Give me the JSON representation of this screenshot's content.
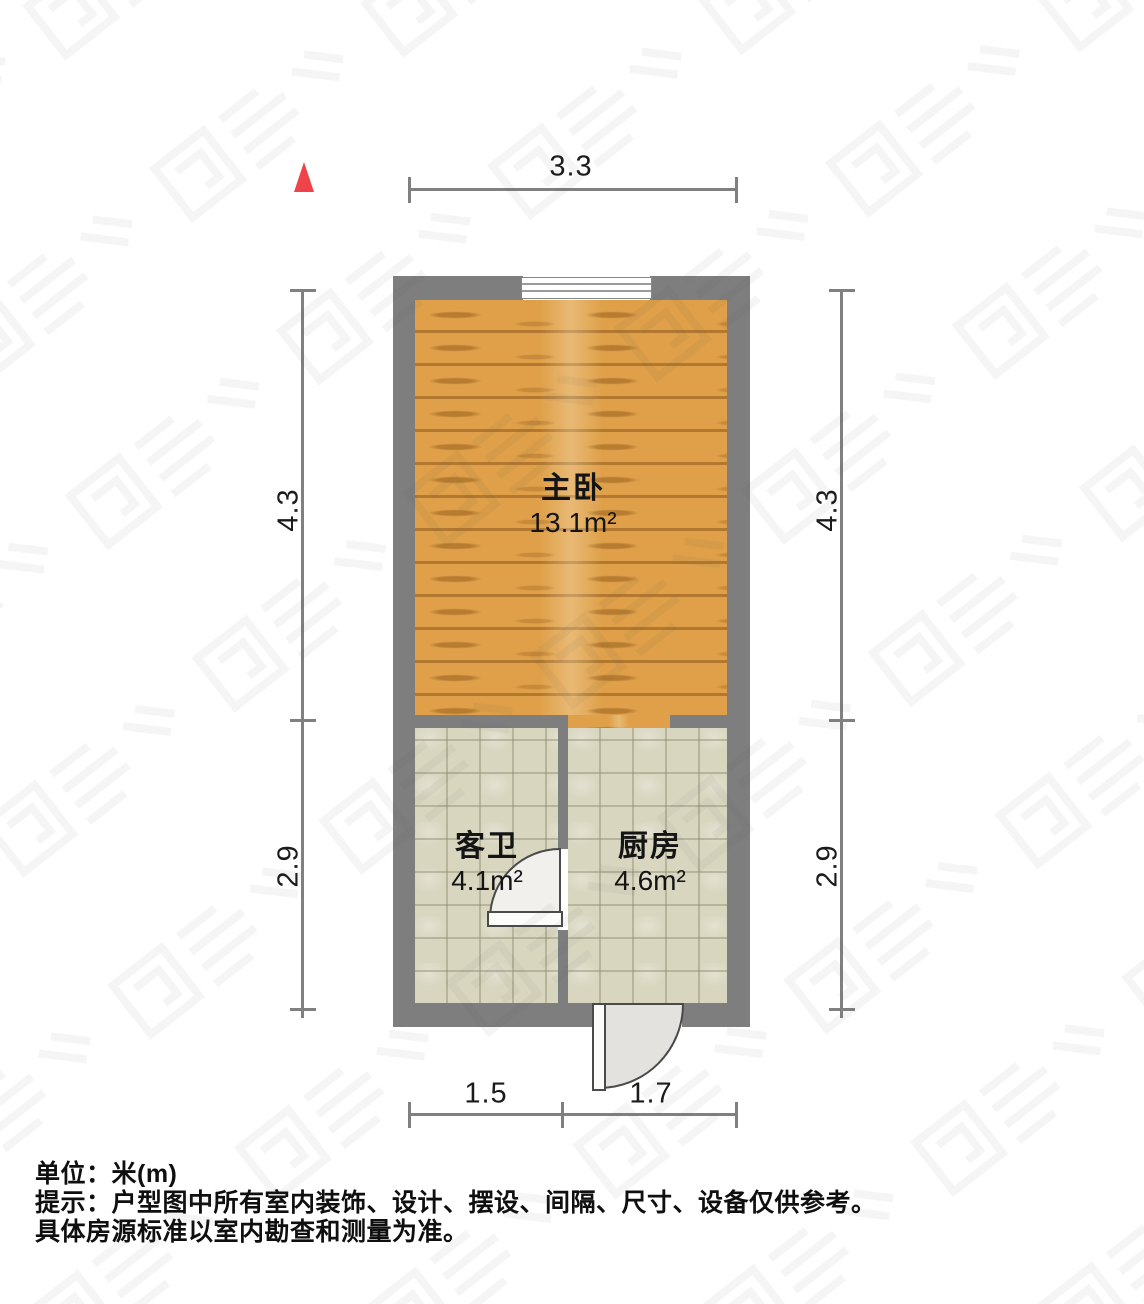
{
  "plan": {
    "rooms": [
      {
        "name": "主卧",
        "area": "13.1m²",
        "floor": "wood"
      },
      {
        "name": "客卫",
        "area": "4.1m²",
        "floor": "tile"
      },
      {
        "name": "厨房",
        "area": "4.6m²",
        "floor": "tile"
      }
    ],
    "dimensions": {
      "top": "3.3",
      "left_upper": "4.3",
      "left_lower": "2.9",
      "right_upper": "4.3",
      "right_lower": "2.9",
      "bottom_left": "1.5",
      "bottom_right": "1.7"
    },
    "compass": {
      "direction": "north",
      "color": "#EE4348"
    }
  },
  "notes": {
    "unit_line": "单位：米(m)",
    "tip_line1": "提示：户型图中所有室内装饰、设计、摆设、间隔、尺寸、设备仅供参考。",
    "tip_line2": "具体房源标准以室内勘查和测量为准。"
  },
  "colors": {
    "wall": "#7E7E7E",
    "wood_floor": "#DFA049",
    "tile_floor": "#D9D6C0",
    "dimension_line": "#808080",
    "north_arrow": "#EE4348"
  }
}
